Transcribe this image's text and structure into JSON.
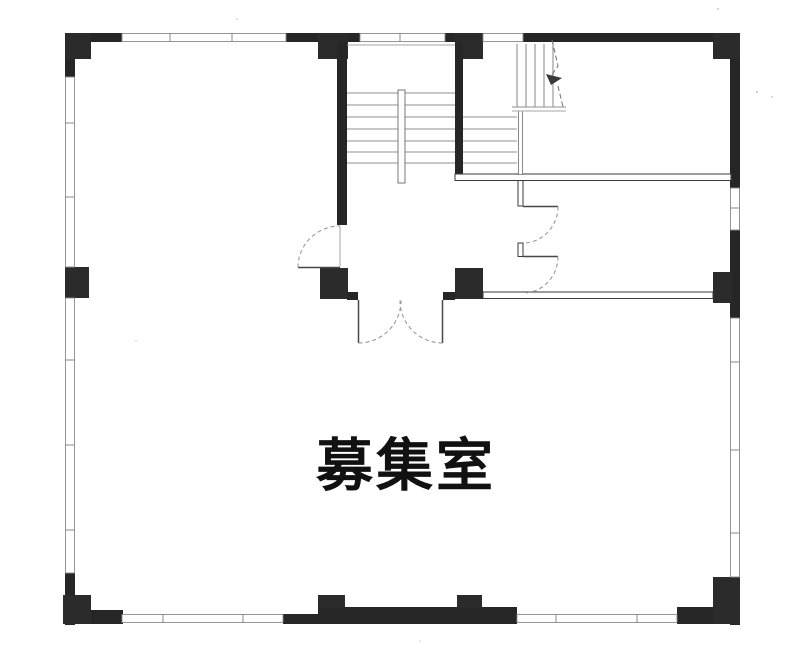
{
  "floor_plan": {
    "room_label": "募集室",
    "features": {
      "stairwell": "U-shaped stair with center handrail and up-direction arrow",
      "entrance": "double swing door from stair hall into main room",
      "side_rooms": "two rooms on upper right, each with single swing door"
    },
    "colors": {
      "wall": "#262626",
      "paper": "#ffffff",
      "stair_line": "#8f8f8f",
      "door_arc": "#9a9a9a",
      "label_text": "#111111"
    }
  }
}
